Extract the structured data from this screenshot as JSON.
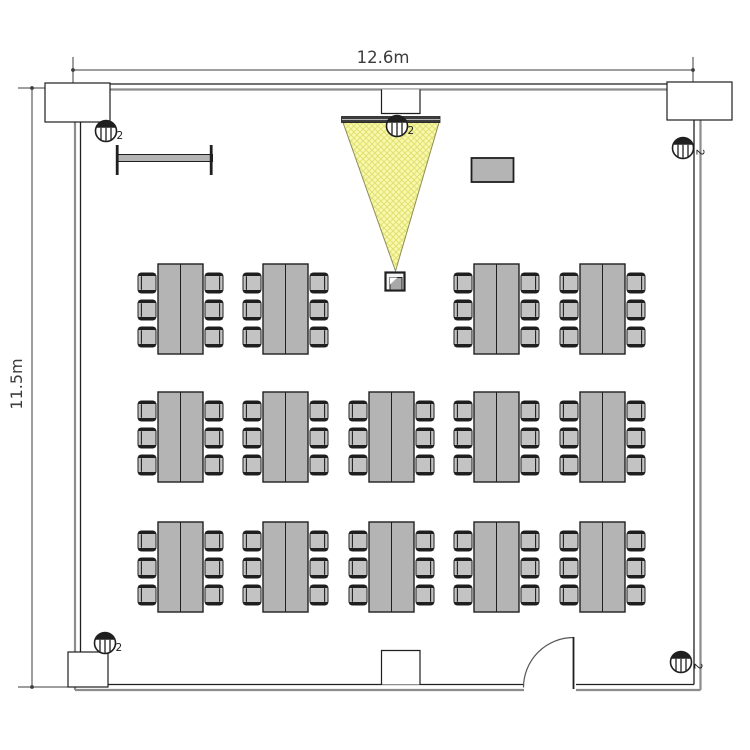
{
  "diagram": {
    "type": "floor-plan",
    "room": {
      "width_label": "12.6m",
      "height_label": "11.5m"
    },
    "speakers": {
      "count_label": "2",
      "positions": [
        {
          "id": "top-left",
          "x": 106,
          "y": 131,
          "label_rotated": false
        },
        {
          "id": "top-center",
          "x": 397,
          "y": 126,
          "label_rotated": false
        },
        {
          "id": "top-right",
          "x": 683,
          "y": 148,
          "label_rotated": true
        },
        {
          "id": "bottom-left",
          "x": 105,
          "y": 643,
          "label_rotated": false
        },
        {
          "id": "bottom-right",
          "x": 681,
          "y": 662,
          "label_rotated": true
        }
      ]
    },
    "projection": {
      "screen": {
        "x": 341.5,
        "y": 116.5,
        "w": 98.5,
        "h": 6
      },
      "cone": {
        "x1": 343,
        "y1": 122.5,
        "x2": 439,
        "y2": 122.5,
        "apex_x": 395.5,
        "apex_y": 271
      },
      "projector": {
        "x": 385.5,
        "y": 272.5,
        "w": 19,
        "h": 18
      }
    },
    "furniture": {
      "whiteboard": {
        "x": 117,
        "y": 154.5,
        "w": 95.5,
        "h": 7,
        "cap_h": 30
      },
      "cabinet": {
        "x": 471.5,
        "y": 158,
        "w": 42,
        "h": 24
      },
      "table_grid": {
        "columns_x": [
          158,
          263,
          369,
          474,
          580
        ],
        "rows_y": [
          264,
          392,
          522
        ],
        "table_w": 45,
        "table_h": 90,
        "omitted_cells": [
          [
            0,
            2
          ]
        ],
        "chair_w": 18,
        "chair_h": 20,
        "chair_offsets_y": [
          9,
          36,
          63
        ],
        "chair_gap": 2,
        "chairs_per_table": 6,
        "table_count": 14
      }
    },
    "colors": {
      "ink": "#1f1f1f",
      "dim": "#3c3c3c",
      "wall_gray": "#8c8c8c",
      "furniture_fill": "#b4b4b4",
      "chair_fill": "#c3c3c3",
      "cone_fill": "#f9f9ae",
      "cone_hatch": "#e0e072",
      "cone_edge": "#8e8e55",
      "screen_fill": "#3d3d3d"
    }
  }
}
